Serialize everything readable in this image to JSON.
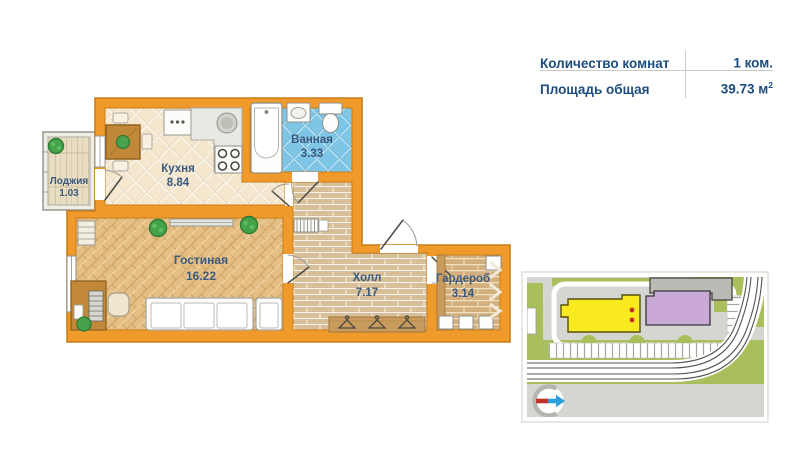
{
  "info_panel": {
    "rows": [
      {
        "label": "Количество комнат",
        "value": "1 ком.",
        "sup": ""
      },
      {
        "label": "Площадь общая",
        "value": "39.73 м",
        "sup": "2"
      }
    ]
  },
  "floor_plan": {
    "rooms": [
      {
        "id": "loggia",
        "name": "Лоджия",
        "area": "1.03"
      },
      {
        "id": "kitchen",
        "name": "Кухня",
        "area": "8.84"
      },
      {
        "id": "bathroom",
        "name": "Ванная",
        "area": "3.33"
      },
      {
        "id": "living",
        "name": "Гостиная",
        "area": "16.22"
      },
      {
        "id": "hall",
        "name": "Холл",
        "area": "7.17"
      },
      {
        "id": "wardrobe",
        "name": "Гардероб",
        "area": "3.14"
      }
    ],
    "colors": {
      "walls": "#F09A2B",
      "wall_edge": "#C77E17",
      "bath_tile": "#7EC5E6",
      "kitchen_tile": "#F4E7CE",
      "label_text": "#3B5A7D"
    }
  },
  "site_map": {
    "highlighted_building_color": "#F8EA1E",
    "secondary_building_color": "#CBA9D6",
    "greenery_color": "#A9BF5B",
    "marker_dots_color": "#C23327"
  }
}
